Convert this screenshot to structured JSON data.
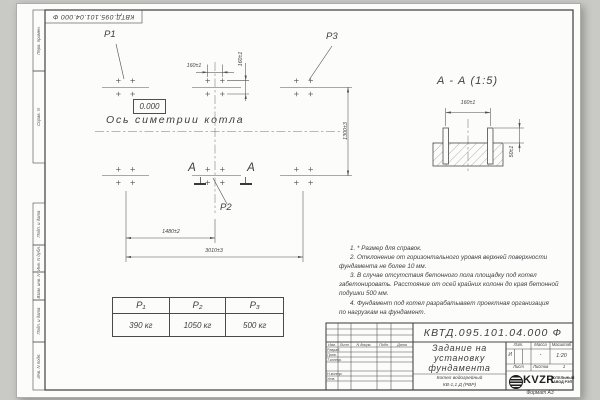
{
  "margin": {
    "perv_primen": "Перв. примен.",
    "sprav_n": "Справ. N",
    "podp_data_1": "Подп. и дата",
    "inv_dubl": "Инв. N дубл.",
    "vzam_inv": "Взам. инв. N",
    "podp_data_2": "Подп. и дата",
    "inv_podl": "Инв. N подл."
  },
  "plan": {
    "p1": "P1",
    "p2": "P2",
    "p3": "P3",
    "elevation": "0.000",
    "axis_label": "Ось симетрии котла",
    "section_a_left": "А",
    "section_a_right": "А",
    "dim_160_h": "160±1",
    "dim_160_v": "160±1",
    "dim_1300": "1300±3",
    "dim_1480": "1480±2",
    "dim_3010": "3010±3"
  },
  "section": {
    "title": "А - А (1:5)",
    "dim_160": "160±1",
    "dim_50": "50±1"
  },
  "notes": {
    "lines": [
      "1. * Размер для справок.",
      "2. Отклонение от горизонтального уровня верхней поверхности",
      "фундамента не более 10 мм.",
      "3. В случае отсутствия бетонного пола площадку под котел",
      "забетонировать. Расстояние от осей крайних колонн до края бетонной",
      "подушки 500 мм.",
      "4. Фундамент под котел разрабатывает проектная организация",
      "по нагрузкам на фундамент."
    ]
  },
  "load_table": {
    "headers": [
      "P₁",
      "P₂",
      "P₃"
    ],
    "values": [
      "390 кг",
      "1050 кг",
      "500 кг"
    ]
  },
  "title_block": {
    "designation": "КВТД.095.101.04.000  Ф",
    "title_line1": "Задание на",
    "title_line2": "установку",
    "title_line3": "фундамента",
    "product_line1": "Котел водогрейный",
    "product_line2": "КВ-1,1 Д (РВР)",
    "col_izm": "Изм.",
    "col_list": "Лист",
    "col_docum": "N докум.",
    "col_podp": "Подп.",
    "col_data": "Дата",
    "row_razrab": "Разраб.",
    "row_prov": "Пров.",
    "row_tkontr": "Т.контр.",
    "row_nkontr": "Н.контр.",
    "row_utv": "Утв.",
    "lit_label": "Лит.",
    "lit_value": "И",
    "mass_label": "Масса",
    "mass_value": "-",
    "scale_label": "Масштаб",
    "scale_value": "1:20",
    "list_label": "Лист",
    "listov_label": "Листов",
    "listov_value": "1",
    "logo_text": "KVZR",
    "logo_sub1": "КОТЕЛЬНЫЙ",
    "logo_sub2": "ЗАВОД РЭП",
    "format_note": "Формат А3"
  }
}
